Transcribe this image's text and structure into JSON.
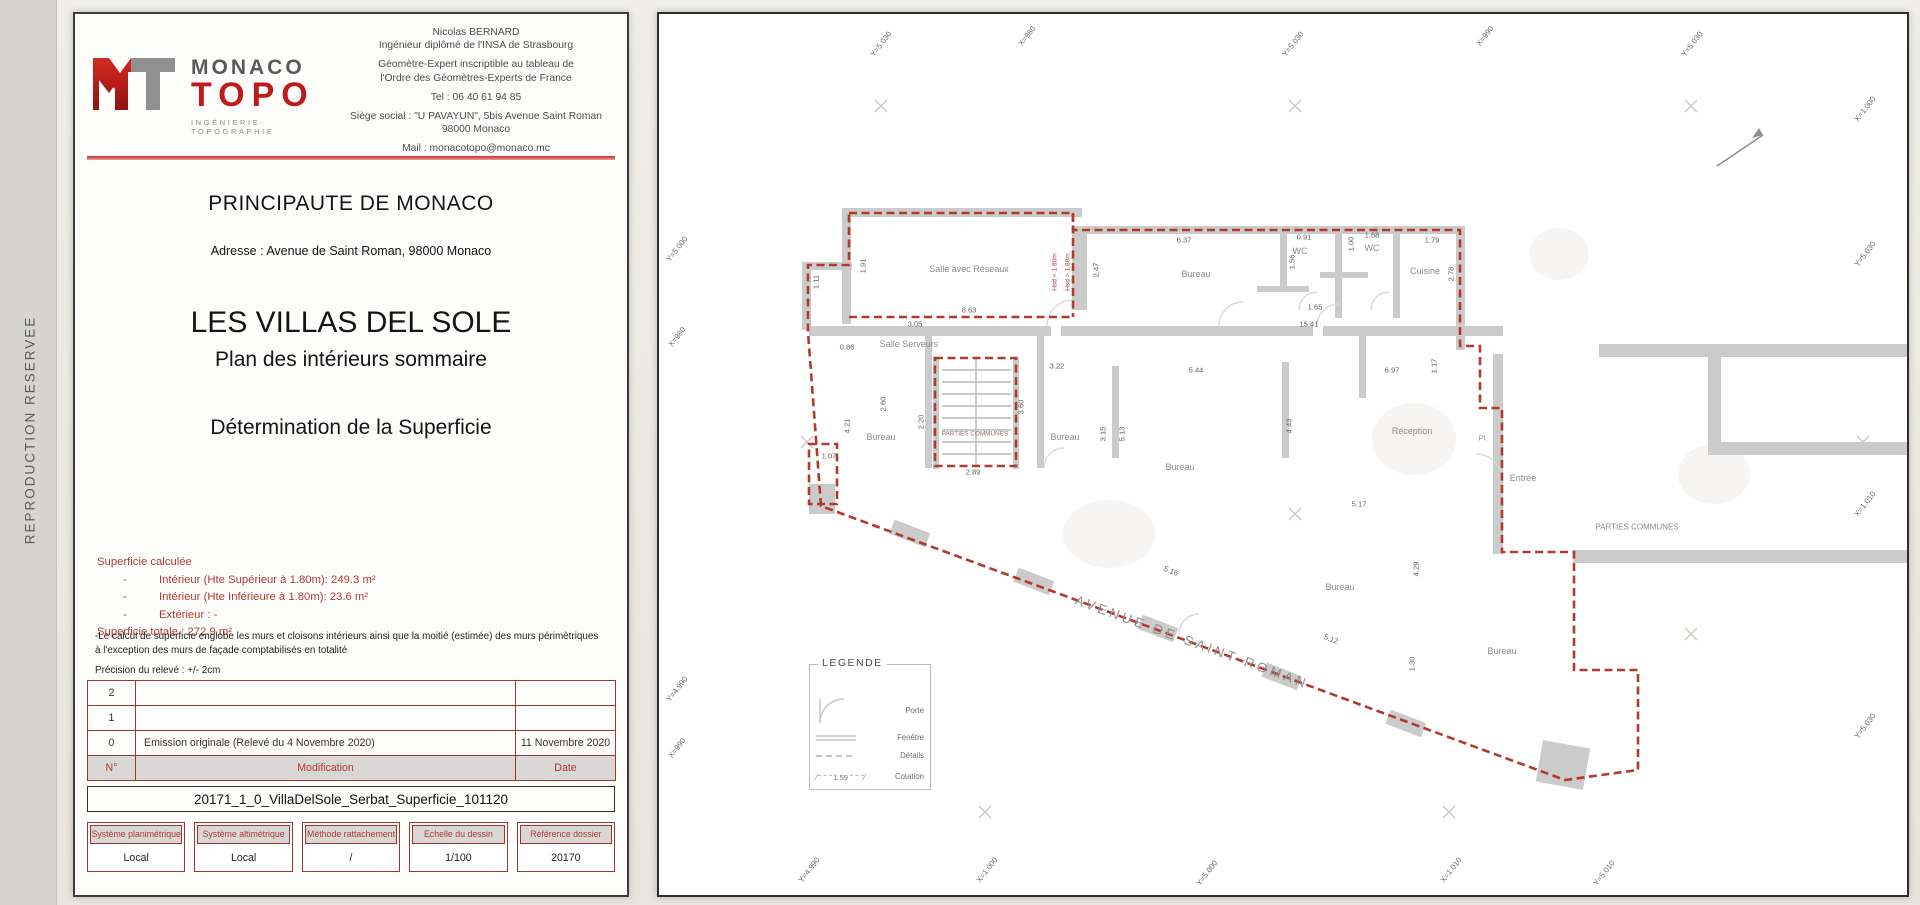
{
  "side": {
    "watermark": "REPRODUCTION RESERVEE"
  },
  "title_block": {
    "logo": {
      "brand_top": "MONACO",
      "brand_bottom": "TOPO",
      "tagline": "INGÉNIERIE· TOPOGRAPHIE"
    },
    "contact": {
      "name": "Nicolas BERNARD",
      "line2": "Ingénieur diplômé de l'INSA de Strasbourg",
      "line3": "Géomètre-Expert inscriptible au tableau de",
      "line4": "l'Ordre des Géomètres-Experts de France",
      "tel": "Tel : 06 40 61 94 85",
      "siege1": "Siège social : \"U PAVAYUN\", 5bis Avenue Saint Roman",
      "siege2": "98000 Monaco",
      "mail": "Mail : monacotopo@monaco.mc"
    },
    "country": "PRINCIPAUTE DE MONACO",
    "address": "Adresse : Avenue de Saint Roman, 98000 Monaco",
    "project": "LES VILLAS DEL SOLE",
    "subtitle": "Plan des intérieurs sommaire",
    "subtitle2": "Détermination de la Superficie",
    "superficie": {
      "title": "Superficie calculée",
      "items": [
        "Intérieur (Hte Supérieur à 1.80m): 249.3 m²",
        "Intérieur (Hte Inférieure à 1.80m): 23.6 m²",
        "Extérieur : -"
      ],
      "total": "Superficie totale : 272.9 m²"
    },
    "notes": {
      "n1": "-Le calcul de superficie englobe les murs et cloisons intérieurs ainsi que la moitié (estimée) des murs périmètriques à l'exception des murs de façade comptabilisés en totalité",
      "n2": "Précision du relevé : +/- 2cm"
    },
    "revision_table": {
      "header": {
        "num": "N°",
        "mod": "Modification",
        "date": "Date"
      },
      "rows": [
        {
          "num": "2",
          "mod": "",
          "date": ""
        },
        {
          "num": "1",
          "mod": "",
          "date": ""
        },
        {
          "num": "0",
          "mod": "Emission originale (Relevé du 4 Novembre 2020)",
          "date": "11 Novembre 2020"
        }
      ]
    },
    "filename": "20171_1_0_VillaDelSole_Serbat_Superficie_101120",
    "info_boxes": [
      {
        "label": "Système planimétrique",
        "value": "Local"
      },
      {
        "label": "Système altimétrique",
        "value": "Local"
      },
      {
        "label": "Méthode rattachement",
        "value": "/"
      },
      {
        "label": "Echelle du dessin",
        "value": "1/100"
      },
      {
        "label": "Référence dossier",
        "value": "20170"
      }
    ]
  },
  "plan": {
    "street": "AVENUE DE SAINT ROMAN",
    "legend": {
      "title": "LEGENDE",
      "items": [
        "Porte",
        "Fenêtre",
        "Détails",
        "Cotation"
      ],
      "sample": "1.59"
    },
    "height_notes": [
      {
        "v": "Hsd < 1.80m",
        "x": 396,
        "y": 258,
        "r": -90
      },
      {
        "v": "Hsd > 1.80m",
        "x": 409,
        "y": 258,
        "r": -90
      }
    ],
    "rooms": [
      {
        "v": "Salle avec Réseaux",
        "x": 310,
        "y": 255
      },
      {
        "v": "Salle Serveurs",
        "x": 250,
        "y": 330
      },
      {
        "v": "Bureau",
        "x": 537,
        "y": 260
      },
      {
        "v": "WC",
        "x": 641,
        "y": 237
      },
      {
        "v": "WC",
        "x": 713,
        "y": 234
      },
      {
        "v": "Cuisine",
        "x": 766,
        "y": 257
      },
      {
        "v": "PARTIES COMMUNES",
        "x": 316,
        "y": 420,
        "fs": 6.4,
        "c": "#9a6a62"
      },
      {
        "v": "Bureau",
        "x": 222,
        "y": 423
      },
      {
        "v": "Bureau",
        "x": 406,
        "y": 423
      },
      {
        "v": "Bureau",
        "x": 521,
        "y": 453
      },
      {
        "v": "Réception",
        "x": 753,
        "y": 417
      },
      {
        "v": "Pl.",
        "x": 824,
        "y": 424,
        "fs": 7.5
      },
      {
        "v": "Entrée",
        "x": 864,
        "y": 464
      },
      {
        "v": "Bureau",
        "x": 681,
        "y": 573
      },
      {
        "v": "Bureau",
        "x": 843,
        "y": 637
      },
      {
        "v": "PARTIES COMMUNES",
        "x": 978,
        "y": 513,
        "fs": 8
      }
    ],
    "dims": [
      {
        "v": "1.91",
        "x": 204,
        "y": 252,
        "r": -90
      },
      {
        "v": "8.63",
        "x": 310,
        "y": 296
      },
      {
        "v": "3.05",
        "x": 256,
        "y": 310
      },
      {
        "v": "0.86",
        "x": 188,
        "y": 333
      },
      {
        "v": "15.41",
        "x": 650,
        "y": 310
      },
      {
        "v": "6.37",
        "x": 525,
        "y": 226
      },
      {
        "v": "2.47",
        "x": 437,
        "y": 256,
        "r": -90
      },
      {
        "v": "0.91",
        "x": 645,
        "y": 223
      },
      {
        "v": "1.56",
        "x": 633,
        "y": 248,
        "r": -90
      },
      {
        "v": "1.68",
        "x": 713,
        "y": 221
      },
      {
        "v": "1.00",
        "x": 692,
        "y": 230,
        "r": -90
      },
      {
        "v": "1.79",
        "x": 773,
        "y": 226
      },
      {
        "v": "2.78",
        "x": 792,
        "y": 260,
        "r": -90
      },
      {
        "v": "1.65",
        "x": 656,
        "y": 293
      },
      {
        "v": "1.17",
        "x": 775,
        "y": 352,
        "r": -90
      },
      {
        "v": "3.22",
        "x": 398,
        "y": 352
      },
      {
        "v": "5.44",
        "x": 537,
        "y": 356
      },
      {
        "v": "6.97",
        "x": 733,
        "y": 356
      },
      {
        "v": "2.60",
        "x": 224,
        "y": 390,
        "r": -90
      },
      {
        "v": "2.20",
        "x": 262,
        "y": 408,
        "r": -90
      },
      {
        "v": "3.60",
        "x": 362,
        "y": 393,
        "r": -90
      },
      {
        "v": "2.89",
        "x": 314,
        "y": 458
      },
      {
        "v": "3.15",
        "x": 444,
        "y": 420,
        "r": -90
      },
      {
        "v": "5.13",
        "x": 463,
        "y": 420,
        "r": -90
      },
      {
        "v": "4.43",
        "x": 630,
        "y": 412,
        "r": -90
      },
      {
        "v": "5.17",
        "x": 700,
        "y": 490
      },
      {
        "v": "4.29",
        "x": 757,
        "y": 555,
        "r": -90
      },
      {
        "v": "5.16",
        "x": 512,
        "y": 557,
        "r": 21
      },
      {
        "v": "5.12",
        "x": 672,
        "y": 625,
        "r": 21
      },
      {
        "v": "1.30",
        "x": 753,
        "y": 650,
        "r": -90
      },
      {
        "v": "1.07",
        "x": 170,
        "y": 442
      },
      {
        "v": "4.21",
        "x": 188,
        "y": 412,
        "r": -90
      },
      {
        "v": "1.11",
        "x": 157,
        "y": 268,
        "r": -90
      }
    ],
    "grid_labels": [
      {
        "v": "Y=5.030",
        "x": 222,
        "y": 30
      },
      {
        "v": "X=980",
        "x": 368,
        "y": 22
      },
      {
        "v": "Y=5.030",
        "x": 634,
        "y": 30
      },
      {
        "v": "X=990",
        "x": 826,
        "y": 22
      },
      {
        "v": "Y=5.030",
        "x": 1033,
        "y": 30
      },
      {
        "v": "X=1.000",
        "x": 1206,
        "y": 95
      },
      {
        "v": "Y=5.030",
        "x": 1206,
        "y": 240
      },
      {
        "v": "X=1.010",
        "x": 1206,
        "y": 490
      },
      {
        "v": "Y=5.030",
        "x": 1206,
        "y": 712
      },
      {
        "v": "Y=5.000",
        "x": 18,
        "y": 235
      },
      {
        "v": "X=980",
        "x": 18,
        "y": 323
      },
      {
        "v": "Y=4.990",
        "x": 18,
        "y": 675
      },
      {
        "v": "X=990",
        "x": 18,
        "y": 734
      },
      {
        "v": "Y=4.990",
        "x": 150,
        "y": 856
      },
      {
        "v": "X=1.000",
        "x": 328,
        "y": 856
      },
      {
        "v": "Y=5.000",
        "x": 548,
        "y": 859
      },
      {
        "v": "X=1.010",
        "x": 792,
        "y": 856
      },
      {
        "v": "Y=5.010",
        "x": 945,
        "y": 859
      }
    ]
  },
  "colors": {
    "accent_red": "#b23a2e",
    "wall_gray": "#cbcbcb",
    "header_gray": "#d8d7d6"
  }
}
